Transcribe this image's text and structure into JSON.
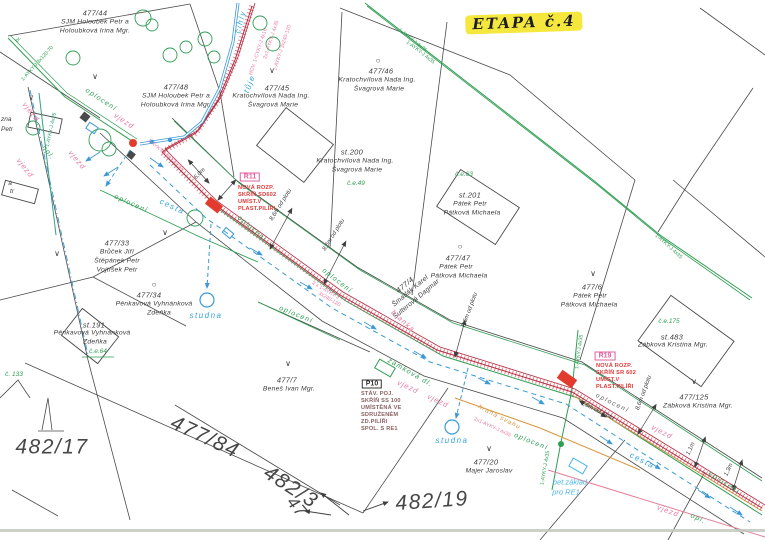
{
  "stage_note": "ETAPA č.4",
  "colors": {
    "paper": "#ffffff",
    "boundary": "#4a4a4a",
    "fence_green": "#2f9e53",
    "teal": "#2fa37e",
    "water_blue": "#3a99d6",
    "cyan": "#49b6e8",
    "driveway_pink": "#e87ba4",
    "cable_band": "#c03048",
    "cabinet_red": "#e23b2e",
    "slope_orange": "#d8973f",
    "p10_maroon": "#8a6060",
    "highlight_yellow": "#f6e73f"
  },
  "texts": [
    {
      "n": "stage-note",
      "t": "ETAPA č.4",
      "x": 524,
      "y": 23,
      "r": -2,
      "c": "etapa"
    },
    {
      "n": "parcel-477-44-number",
      "t": "477/44",
      "x": 95,
      "y": 13,
      "c": "pn"
    },
    {
      "n": "parcel-477-44-owner",
      "t": "SJM Holoubek Petr a",
      "x": 95,
      "y": 23,
      "c": "on"
    },
    {
      "n": "parcel-477-44-owner",
      "t": "Holoubková Irina Mgr.",
      "x": 95,
      "y": 32,
      "c": "on"
    },
    {
      "n": "parcel-477-48-number",
      "t": "477/48",
      "x": 176,
      "y": 87,
      "c": "pn"
    },
    {
      "n": "parcel-477-48-owner",
      "t": "SJM Holoubek Petr a",
      "x": 176,
      "y": 97,
      "c": "on"
    },
    {
      "n": "parcel-477-48-owner",
      "t": "Holoubková Irina Mgr.",
      "x": 176,
      "y": 106,
      "c": "on"
    },
    {
      "n": "parcel-477-45-number",
      "t": "477/45",
      "x": 277,
      "y": 88,
      "c": "pn"
    },
    {
      "n": "parcel-477-45-owner",
      "t": "Kratochvílová Nada Ing.",
      "x": 271,
      "y": 97,
      "c": "on"
    },
    {
      "n": "parcel-477-45-owner",
      "t": "Švagrová Marie",
      "x": 273,
      "y": 106,
      "c": "on"
    },
    {
      "n": "parcel-477-46-number",
      "t": "477/46",
      "x": 381,
      "y": 71,
      "c": "pn"
    },
    {
      "n": "parcel-477-46-owner",
      "t": "Kratochvílová Nada Ing.",
      "x": 377,
      "y": 81,
      "c": "on"
    },
    {
      "n": "parcel-477-46-owner",
      "t": "Švagrová Marie",
      "x": 379,
      "y": 90,
      "c": "on"
    },
    {
      "n": "parcel-st200-number",
      "t": "st.200",
      "x": 352,
      "y": 152,
      "c": "pn"
    },
    {
      "n": "parcel-st200-owner",
      "t": "Kratochvílová Nada Ing.",
      "x": 355,
      "y": 162,
      "c": "on"
    },
    {
      "n": "parcel-st200-owner",
      "t": "Švagrová Marie",
      "x": 357,
      "y": 171,
      "c": "on"
    },
    {
      "n": "parcel-ce49",
      "t": "č.e.49",
      "x": 356,
      "y": 184,
      "c": "grn"
    },
    {
      "n": "parcel-ce63",
      "t": "č.e.63",
      "x": 464,
      "y": 175,
      "c": "grn"
    },
    {
      "n": "parcel-st201-number",
      "t": "st.201",
      "x": 470,
      "y": 195,
      "c": "pn"
    },
    {
      "n": "parcel-st201-owner",
      "t": "Pátek Petr",
      "x": 470,
      "y": 205,
      "c": "on"
    },
    {
      "n": "parcel-st201-owner",
      "t": "Pátková Michaela",
      "x": 472,
      "y": 214,
      "c": "on"
    },
    {
      "n": "parcel-477-47-number",
      "t": "477/47",
      "x": 458,
      "y": 258,
      "c": "pn"
    },
    {
      "n": "parcel-477-47-owner",
      "t": "Pátek Petr",
      "x": 456,
      "y": 268,
      "c": "on"
    },
    {
      "n": "parcel-477-47-owner",
      "t": "Pátková Michaela",
      "x": 459,
      "y": 277,
      "c": "on"
    },
    {
      "n": "parcel-477-4-number",
      "t": "477/4",
      "x": 405,
      "y": 285,
      "r": -40,
      "c": "pn"
    },
    {
      "n": "parcel-477-4-owner",
      "t": "Šmatlák Karel",
      "x": 411,
      "y": 292,
      "r": -40,
      "c": "on"
    },
    {
      "n": "parcel-477-4-owner",
      "t": "Šulterová Dagmar",
      "x": 417,
      "y": 300,
      "r": -40,
      "c": "on"
    },
    {
      "n": "parcel-477-6-number",
      "t": "477/6",
      "x": 592,
      "y": 287,
      "c": "pn"
    },
    {
      "n": "parcel-477-6-owner",
      "t": "Pátek Petr",
      "x": 590,
      "y": 297,
      "c": "on"
    },
    {
      "n": "parcel-477-6-owner",
      "t": "Pátková Michaela",
      "x": 589,
      "y": 306,
      "c": "on"
    },
    {
      "n": "parcel-ce175",
      "t": "č.e.175",
      "x": 669,
      "y": 322,
      "c": "grn"
    },
    {
      "n": "parcel-st483-number",
      "t": "st.483",
      "x": 672,
      "y": 337,
      "c": "pn"
    },
    {
      "n": "parcel-st483-owner",
      "t": "Zábková Kristina Mgr.",
      "x": 673,
      "y": 346,
      "c": "on"
    },
    {
      "n": "parcel-477-125-number",
      "t": "477/125",
      "x": 694,
      "y": 397,
      "c": "pn"
    },
    {
      "n": "parcel-477-125-owner",
      "t": "Zábková Kristina Mgr.",
      "x": 698,
      "y": 407,
      "c": "on"
    },
    {
      "n": "parcel-477-33-number",
      "t": "477/33",
      "x": 117,
      "y": 243,
      "c": "pn"
    },
    {
      "n": "parcel-477-33-owner",
      "t": "Brůček Jiří",
      "x": 117,
      "y": 253,
      "c": "on"
    },
    {
      "n": "parcel-477-33-owner",
      "t": "Štěpánek Petr",
      "x": 117,
      "y": 262,
      "c": "on"
    },
    {
      "n": "parcel-477-33-owner",
      "t": "Vojtíšek Petr",
      "x": 117,
      "y": 271,
      "c": "on"
    },
    {
      "n": "parcel-477-34-number",
      "t": "477/34",
      "x": 149,
      "y": 295,
      "c": "pn"
    },
    {
      "n": "parcel-477-34-owner",
      "t": "Pěnkavová Vyhnánková",
      "x": 154,
      "y": 305,
      "c": "on"
    },
    {
      "n": "parcel-477-34-owner",
      "t": "Zdeňka",
      "x": 159,
      "y": 314,
      "c": "on"
    },
    {
      "n": "parcel-st191-number",
      "t": "st.191",
      "x": 94,
      "y": 325,
      "c": "pn"
    },
    {
      "n": "parcel-st191-owner",
      "t": "Pěnkavová Vyhnánková",
      "x": 92,
      "y": 334,
      "c": "on"
    },
    {
      "n": "parcel-st191-owner",
      "t": "Zdeňka",
      "x": 95,
      "y": 343,
      "c": "on"
    },
    {
      "n": "parcel-ce64",
      "t": "č.e.64",
      "x": 98,
      "y": 352,
      "c": "grn"
    },
    {
      "n": "parcel-477-7-number",
      "t": "477/7",
      "x": 287,
      "y": 380,
      "c": "pn"
    },
    {
      "n": "parcel-477-7-owner",
      "t": "Beneš Ivan Mgr.",
      "x": 289,
      "y": 390,
      "c": "on"
    },
    {
      "n": "parcel-477-20-number",
      "t": "477/20",
      "x": 486,
      "y": 462,
      "c": "pn"
    },
    {
      "n": "parcel-477-20-owner",
      "t": "Majer Jaroslav",
      "x": 489,
      "y": 472,
      "c": "on"
    },
    {
      "n": "edge-fragment",
      "t": "zna",
      "x": 1,
      "y": 120,
      "a": "l",
      "c": "frag"
    },
    {
      "n": "edge-fragment",
      "t": "Petr",
      "x": 1,
      "y": 130,
      "a": "l",
      "c": "frag"
    },
    {
      "n": "edge-fragment",
      "t": "á",
      "x": 10,
      "y": 184,
      "c": "frag"
    },
    {
      "n": "edge-fragment",
      "t": "tr",
      "x": 12,
      "y": 192,
      "c": "frag"
    },
    {
      "n": "parcel-c133",
      "t": "č. 133",
      "x": 14,
      "y": 375,
      "c": "grn"
    },
    {
      "n": "parcel-482-17-number",
      "t": "482/17",
      "x": 52,
      "y": 447,
      "c": "big"
    },
    {
      "n": "parcel-477-84-number",
      "t": "477/84",
      "x": 205,
      "y": 437,
      "r": 25,
      "c": "big"
    },
    {
      "n": "parcel-482-3-number",
      "t": "482/3",
      "x": 291,
      "y": 487,
      "r": 33,
      "c": "big"
    },
    {
      "n": "parcel-47-number",
      "t": "47",
      "x": 297,
      "y": 507,
      "r": 50,
      "c": "big2"
    },
    {
      "n": "parcel-482-19-number",
      "t": "482/19",
      "x": 432,
      "y": 501,
      "r": -4,
      "c": "big"
    },
    {
      "n": "cabinet-r11-code",
      "t": "R11",
      "x": 250,
      "y": 177,
      "c": "rbox"
    },
    {
      "n": "cabinet-r11-note",
      "t": "NOVÁ ROZP.",
      "x": 238,
      "y": 189,
      "a": "l",
      "c": "red"
    },
    {
      "n": "cabinet-r11-note",
      "t": "SKŘÍŇ SD602",
      "x": 238,
      "y": 196,
      "a": "l",
      "c": "red"
    },
    {
      "n": "cabinet-r11-note",
      "t": "UMÍST.V",
      "x": 238,
      "y": 203,
      "a": "l",
      "c": "red"
    },
    {
      "n": "cabinet-r11-note",
      "t": "PLAST.PILÍŘI",
      "x": 238,
      "y": 210,
      "a": "l",
      "c": "red"
    },
    {
      "n": "cabinet-r19-code",
      "t": "R19",
      "x": 605,
      "y": 356,
      "c": "rbox"
    },
    {
      "n": "cabinet-r19-note",
      "t": "NOVÁ ROZP.",
      "x": 596,
      "y": 367,
      "a": "l",
      "c": "red"
    },
    {
      "n": "cabinet-r19-note",
      "t": "SKŘÍŇ SR 602",
      "x": 596,
      "y": 374,
      "a": "l",
      "c": "red"
    },
    {
      "n": "cabinet-r19-note",
      "t": "UMÍST.V",
      "x": 596,
      "y": 381,
      "a": "l",
      "c": "red"
    },
    {
      "n": "cabinet-r19-note",
      "t": "PLAST.PILÍŘI",
      "x": 596,
      "y": 388,
      "a": "l",
      "c": "red"
    },
    {
      "n": "cabinet-p10-code",
      "t": "P10",
      "x": 372,
      "y": 384,
      "c": "bbox"
    },
    {
      "n": "cabinet-p10-note",
      "t": "STÁV. POJ.",
      "x": 361,
      "y": 395,
      "a": "l",
      "c": "mar"
    },
    {
      "n": "cabinet-p10-note",
      "t": "SKŘÍŇ SS 100",
      "x": 361,
      "y": 402,
      "a": "l",
      "c": "mar"
    },
    {
      "n": "cabinet-p10-note",
      "t": "UMÍSTĚNÁ VE",
      "x": 361,
      "y": 409,
      "a": "l",
      "c": "mar"
    },
    {
      "n": "cabinet-p10-note",
      "t": "SDRUŽENÉM",
      "x": 361,
      "y": 416,
      "a": "l",
      "c": "mar"
    },
    {
      "n": "cabinet-p10-note",
      "t": "ZD.PILÍŘI",
      "x": 361,
      "y": 423,
      "a": "l",
      "c": "mar"
    },
    {
      "n": "cabinet-p10-note",
      "t": "SPOL. S RE1",
      "x": 361,
      "y": 430,
      "a": "l",
      "c": "mar"
    },
    {
      "n": "road-label",
      "t": "cesta",
      "x": 172,
      "y": 207,
      "r": 25,
      "c": "blab"
    },
    {
      "n": "road-label",
      "t": "cesta",
      "x": 642,
      "y": 461,
      "r": 27,
      "c": "blab"
    },
    {
      "n": "well-label",
      "t": "studna",
      "x": 206,
      "y": 316,
      "c": "blab"
    },
    {
      "n": "well-label",
      "t": "studna",
      "x": 452,
      "y": 441,
      "c": "blab"
    },
    {
      "n": "foundation-label",
      "t": "bet.základ",
      "x": 570,
      "y": 482,
      "c": "blab2"
    },
    {
      "n": "foundation-label",
      "t": "pro RE1",
      "x": 566,
      "y": 492,
      "c": "blab2"
    },
    {
      "n": "fence-label",
      "t": "oplocení",
      "x": 101,
      "y": 100,
      "r": 33,
      "c": "glab"
    },
    {
      "n": "fence-label",
      "t": "oplocení",
      "x": 131,
      "y": 204,
      "r": 24,
      "c": "glab"
    },
    {
      "n": "fence-label",
      "t": "oplocení",
      "x": 252,
      "y": 229,
      "r": 40,
      "c": "glab"
    },
    {
      "n": "fence-label",
      "t": "oplocení",
      "x": 337,
      "y": 281,
      "r": 38,
      "c": "glab"
    },
    {
      "n": "fence-label",
      "t": "oplocení",
      "x": 296,
      "y": 315,
      "r": 22,
      "c": "glab"
    },
    {
      "n": "fence-label",
      "t": "oplocení",
      "x": 531,
      "y": 442,
      "r": 22,
      "c": "glab"
    },
    {
      "n": "fence-label",
      "t": "oplocení",
      "x": 724,
      "y": 483,
      "r": 33,
      "c": "glab"
    },
    {
      "n": "fence-label",
      "t": "opl.",
      "x": 48,
      "y": 153,
      "r": 52,
      "c": "glab"
    },
    {
      "n": "fence-label",
      "t": "opl.",
      "x": 698,
      "y": 519,
      "r": 25,
      "c": "glab"
    },
    {
      "n": "fence-label",
      "t": "oplocení",
      "x": 612,
      "y": 404,
      "r": 26,
      "c": "klab"
    },
    {
      "n": "driveway-label",
      "t": "vjezd",
      "x": 31,
      "y": 112,
      "r": 52,
      "c": "plab"
    },
    {
      "n": "driveway-label",
      "t": "vjezd",
      "x": 25,
      "y": 168,
      "r": 52,
      "c": "plab"
    },
    {
      "n": "driveway-label",
      "t": "vjezd",
      "x": 77,
      "y": 160,
      "r": 50,
      "c": "plab"
    },
    {
      "n": "driveway-label",
      "t": "vjezd",
      "x": 124,
      "y": 121,
      "r": 33,
      "c": "plab"
    },
    {
      "n": "driveway-label",
      "t": "vjezd",
      "x": 408,
      "y": 387,
      "r": 25,
      "c": "plab"
    },
    {
      "n": "driveway-label",
      "t": "vjezd",
      "x": 438,
      "y": 401,
      "r": 25,
      "c": "plab"
    },
    {
      "n": "driveway-label",
      "t": "vjezd",
      "x": 662,
      "y": 432,
      "r": 27,
      "c": "plab"
    },
    {
      "n": "driveway-label",
      "t": "vjezd",
      "x": 668,
      "y": 511,
      "r": 20,
      "c": "plab"
    },
    {
      "n": "gate-label",
      "t": "branka",
      "x": 403,
      "y": 321,
      "r": 42,
      "c": "plab"
    },
    {
      "n": "paving-label",
      "t": "zámková dl.",
      "x": 410,
      "y": 373,
      "r": 30,
      "c": "glab"
    },
    {
      "n": "slope-label",
      "t": "hrana svahu",
      "x": 499,
      "y": 418,
      "r": 27,
      "c": "olab"
    },
    {
      "n": "material-label",
      "t": "cihly",
      "x": 241,
      "y": 22,
      "r": -75,
      "c": "blab"
    },
    {
      "n": "hedge-label",
      "t": "tůje",
      "x": 250,
      "y": 84,
      "r": -68,
      "c": "blab"
    },
    {
      "n": "survey-mark",
      "t": "∨",
      "x": 95,
      "y": 77,
      "c": "vmark"
    },
    {
      "n": "survey-mark",
      "t": "∨",
      "x": 272,
      "y": 71,
      "c": "vmark"
    },
    {
      "n": "survey-mark",
      "t": "∨",
      "x": 31,
      "y": 98,
      "c": "vmark"
    },
    {
      "n": "survey-mark",
      "t": "∨",
      "x": 57,
      "y": 254,
      "c": "vmark"
    },
    {
      "n": "survey-mark",
      "t": "∨",
      "x": 165,
      "y": 233,
      "c": "vmark"
    },
    {
      "n": "survey-mark",
      "t": "∨",
      "x": 593,
      "y": 274,
      "c": "vmark"
    },
    {
      "n": "survey-mark",
      "t": "∨",
      "x": 288,
      "y": 364,
      "c": "vmark"
    },
    {
      "n": "survey-mark",
      "t": "∨",
      "x": 489,
      "y": 449,
      "c": "vmark"
    },
    {
      "n": "survey-mark",
      "t": "∨",
      "x": 694,
      "y": 382,
      "c": "vmark"
    },
    {
      "n": "point-symbol",
      "t": "○",
      "x": 378,
      "y": 61,
      "c": "omark"
    },
    {
      "n": "point-symbol",
      "t": "○",
      "x": 460,
      "y": 247,
      "c": "omark"
    },
    {
      "n": "point-symbol",
      "t": "○",
      "x": 154,
      "y": 285,
      "c": "omark"
    },
    {
      "n": "cable-label",
      "t": "HOV. 1-CYKY-J 4x16",
      "x": 259,
      "y": 52,
      "r": -72,
      "c": "pcab"
    },
    {
      "n": "cable-label",
      "t": "2x1-AYKY-J 4x35",
      "x": 272,
      "y": 40,
      "r": -72,
      "c": "pcab"
    },
    {
      "n": "cable-label",
      "t": "1-AYKY-J 3x240-120",
      "x": 283,
      "y": 48,
      "r": -72,
      "c": "pcab"
    },
    {
      "n": "cable-label",
      "t": "1-AYKY-J 3x120-70",
      "x": 38,
      "y": 64,
      "r": -48,
      "c": "gcab"
    },
    {
      "n": "cable-label",
      "t": "br.",
      "x": 19,
      "y": 40,
      "r": -48,
      "c": "gcab"
    },
    {
      "n": "cable-label",
      "t": "1-AYKY-J 4x25",
      "x": 52,
      "y": 130,
      "r": -78,
      "c": "tcab"
    },
    {
      "n": "cable-label",
      "t": "1-AYKY-J 3x120-70",
      "x": 165,
      "y": 155,
      "r": 40,
      "c": "pcab"
    },
    {
      "n": "cable-label",
      "t": "2 x 1-AYKY-J",
      "x": 325,
      "y": 291,
      "r": 30,
      "c": "pcab"
    },
    {
      "n": "cable-label",
      "t": "3x240-120",
      "x": 329,
      "y": 300,
      "r": 30,
      "c": "pcab"
    },
    {
      "n": "cable-label",
      "t": "2x1-AYKY-J 4x35",
      "x": 492,
      "y": 428,
      "r": 25,
      "c": "pcab"
    },
    {
      "n": "cable-label",
      "t": "1-AYKY-J 4x35",
      "x": 412,
      "y": 41,
      "r": 38,
      "c": "gcab"
    },
    {
      "n": "cable-label",
      "t": "1-AYKY-J 4x35",
      "x": 420,
      "y": 53,
      "r": 38,
      "c": "gcab"
    },
    {
      "n": "cable-label",
      "t": "1-AYKY-J 4x35",
      "x": 668,
      "y": 247,
      "r": 42,
      "c": "gcab"
    },
    {
      "n": "cable-label",
      "t": "1-AYKY-J 4x35",
      "x": 580,
      "y": 352,
      "r": -82,
      "c": "gcab"
    },
    {
      "n": "cable-label",
      "t": "1-AYKY-J 4x35",
      "x": 546,
      "y": 468,
      "r": -80,
      "c": "gcab"
    },
    {
      "n": "dimension-label",
      "t": "6,0m",
      "x": 200,
      "y": 174,
      "r": -45,
      "c": "meas"
    },
    {
      "n": "dimension-label",
      "t": "8,6m od plotu",
      "x": 281,
      "y": 205,
      "r": -58,
      "c": "meas"
    },
    {
      "n": "dimension-label",
      "t": "8,6m od plotu",
      "x": 334,
      "y": 235,
      "r": -58,
      "c": "meas"
    },
    {
      "n": "dimension-label",
      "t": "8,6m od plotu",
      "x": 470,
      "y": 310,
      "r": -70,
      "c": "meas"
    },
    {
      "n": "dimension-label",
      "t": "8,6m od plotu",
      "x": 644,
      "y": 393,
      "r": -70,
      "c": "meas"
    },
    {
      "n": "dimension-label",
      "t": "0,6m od plotu",
      "x": 597,
      "y": 411,
      "r": 26,
      "c": "meas"
    },
    {
      "n": "dimension-label",
      "t": "1,1m",
      "x": 691,
      "y": 449,
      "r": -65,
      "c": "meas"
    },
    {
      "n": "dimension-label",
      "t": "1,3m",
      "x": 729,
      "y": 470,
      "r": -65,
      "c": "meas"
    }
  ]
}
